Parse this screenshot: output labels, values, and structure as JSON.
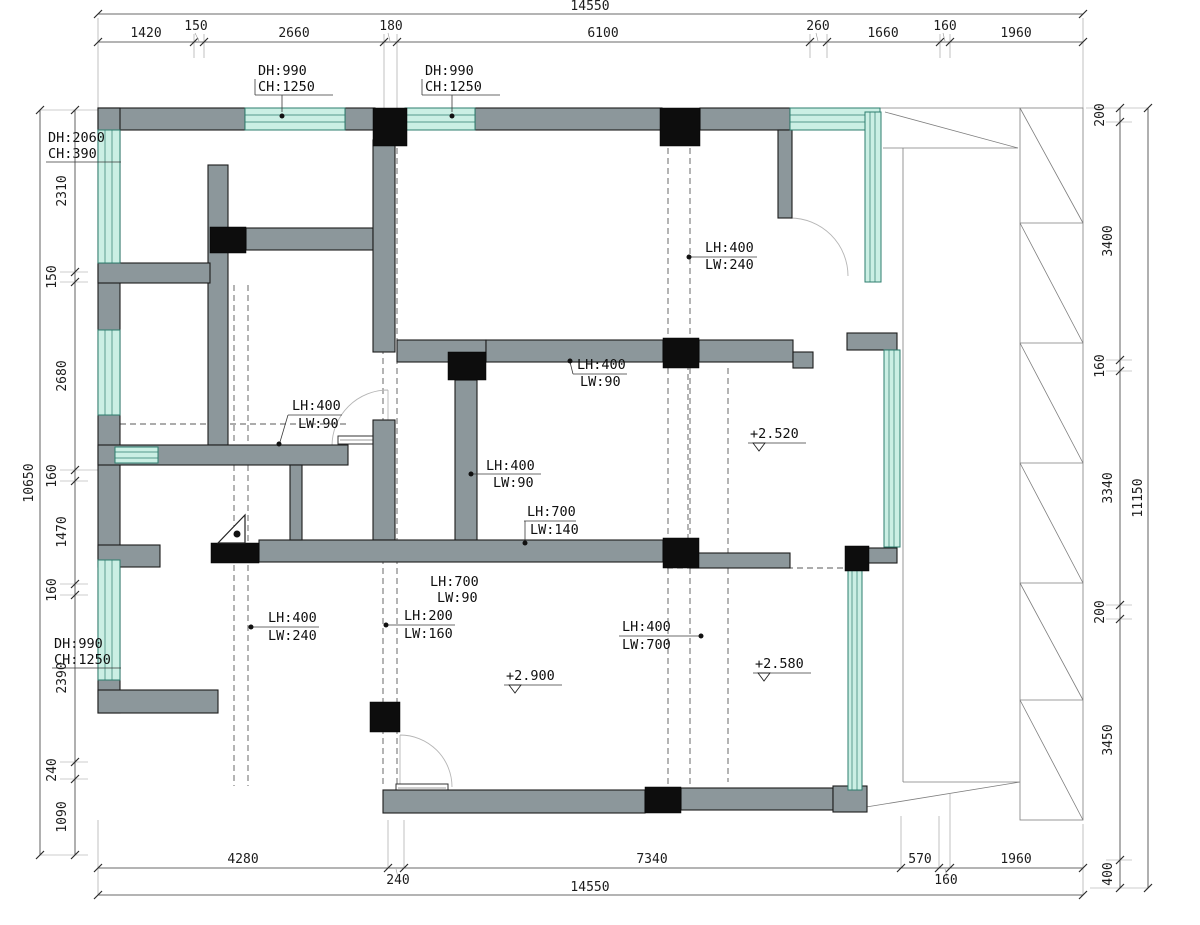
{
  "colors": {
    "wall": "#8C979B",
    "window_fill": "#CBEFE4",
    "window_stroke": "#2E7D6E",
    "column": "#0D0D0D",
    "dim_text": "#1c1c1c",
    "paper": "#FFFFFF"
  },
  "dims": {
    "top": {
      "total": "14550",
      "segments": [
        "1420",
        "150",
        "2660",
        "180",
        "6100",
        "260",
        "1660",
        "160",
        "1960"
      ]
    },
    "bottom": {
      "total": "14550",
      "segments": [
        "4280",
        "240",
        "7340",
        "570",
        "160",
        "1960"
      ]
    },
    "left": {
      "total": "10650",
      "segments": [
        "2310",
        "150",
        "2680",
        "160",
        "1470",
        "160",
        "2390",
        "240",
        "1090"
      ]
    },
    "right": {
      "total": "11150",
      "segments": [
        "200",
        "3400",
        "160",
        "3340",
        "200",
        "3450",
        "400"
      ]
    }
  },
  "window_labels": [
    {
      "line1": "DH:990",
      "line2": "CH:1250"
    },
    {
      "line1": "DH:990",
      "line2": "CH:1250"
    },
    {
      "line1": "DH:2060",
      "line2": "CH:390"
    },
    {
      "line1": "DH:990",
      "line2": "CH:1250"
    }
  ],
  "beam_labels": [
    {
      "line1": "LH:400",
      "line2": "LW:240"
    },
    {
      "line1": "LH:400",
      "line2": "LW:90"
    },
    {
      "line1": "LH:400",
      "line2": "LW:90"
    },
    {
      "line1": "LH:700",
      "line2": "LW:140"
    },
    {
      "line1": "LH:400",
      "line2": "LW:90"
    },
    {
      "line1": "LH:700",
      "line2": "LW:90"
    },
    {
      "line1": "LH:400",
      "line2": "LW:240"
    },
    {
      "line1": "LH:200",
      "line2": "LW:160"
    },
    {
      "line1": "LH:400",
      "line2": "LW:700"
    }
  ],
  "elevations": [
    "+2.520",
    "+2.900",
    "+2.580"
  ]
}
